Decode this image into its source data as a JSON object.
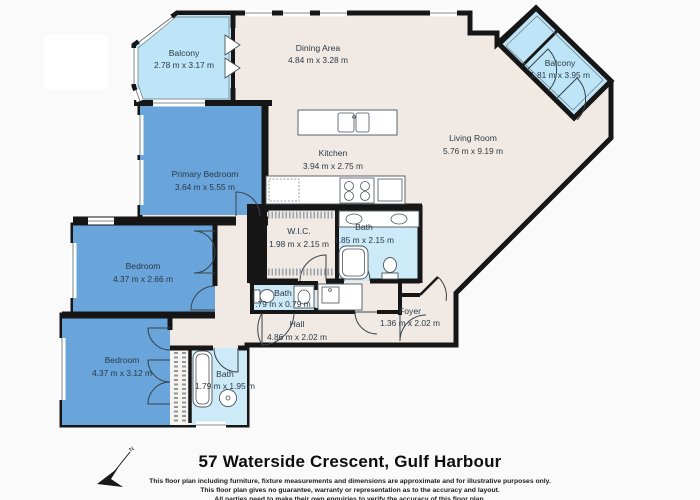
{
  "title": "57 Waterside Crescent, Gulf Harbour",
  "disclaimer": {
    "line1": "This floor plan including furniture, fixture measurements and dimensions are approximate and for illustrative purposes only.",
    "line2": "This floor plan gives no guarantee, warranty or representation as to the accuracy and layout.",
    "line3": "All parties need to make their own enquiries to verify the accuracy of this floor plan."
  },
  "compass": {
    "label": "N"
  },
  "rooms": {
    "balcony_tl": {
      "name": "Balcony",
      "dims": "2.78 m x 3.17 m"
    },
    "dining": {
      "name": "Dining Area",
      "dims": "4.84 m x 3.28 m"
    },
    "balcony_tr": {
      "name": "Balcony",
      "dims": "1.81 m x 3.95 m"
    },
    "living": {
      "name": "Living Room",
      "dims": "5.76 m x 9.19 m"
    },
    "kitchen": {
      "name": "Kitchen",
      "dims": "3.94 m x 2.75 m"
    },
    "primary_bedroom": {
      "name": "Primary Bedroom",
      "dims": "3.64 m x 5.55 m"
    },
    "bedroom_mid": {
      "name": "Bedroom",
      "dims": "4.37 m x 2.66 m"
    },
    "bedroom_bottom": {
      "name": "Bedroom",
      "dims": "4.37 m x 3.12 m"
    },
    "wic": {
      "name": "W.I.C.",
      "dims": "1.98 m x 2.15 m"
    },
    "bath_ensuite": {
      "name": "Bath",
      "dims": "1.85 m x 2.15 m"
    },
    "bath_small": {
      "name": "Bath",
      "dims": ".79 m x 0.79 m"
    },
    "bath_bottom": {
      "name": "Bath",
      "dims": "1.79 m x 1.95 m"
    },
    "hall": {
      "name": "Hall",
      "dims": "4.86 m x 2.02 m"
    },
    "foyer": {
      "name": "Foyer",
      "dims": "1.36 m x 2.02 m"
    }
  },
  "colors": {
    "wall": "#161616",
    "floor": "#f1eae4",
    "bedroom_blue": "#69a5da",
    "bath_blue": "#cdeaf8",
    "balcony_blue": "#bee5f7"
  }
}
